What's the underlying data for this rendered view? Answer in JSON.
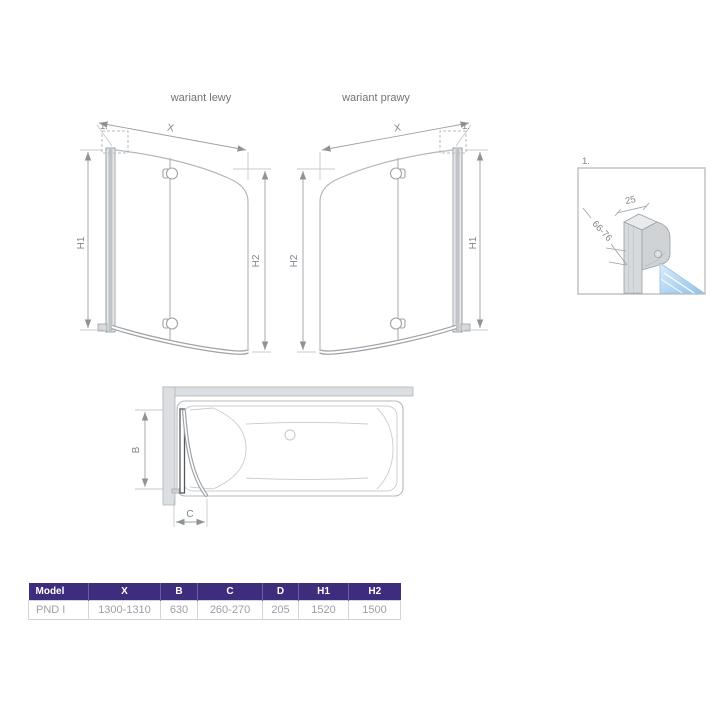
{
  "drawing": {
    "variant_left_title": "wariant lewy",
    "variant_right_title": "wariant prawy",
    "detail_ref": "1.",
    "dim_x": "X",
    "dim_h1": "H1",
    "dim_h2": "H2",
    "dim_b": "B",
    "dim_c": "C",
    "detail_width": "25",
    "detail_depth_range": "66-76"
  },
  "table": {
    "headers": [
      "Model",
      "X",
      "B",
      "C",
      "D",
      "H1",
      "H2"
    ],
    "rows": [
      [
        "PND I",
        "1300-1310",
        "630",
        "260-270",
        "205",
        "1520",
        "1500"
      ]
    ]
  },
  "colors": {
    "header_bg": "#3e2d7c",
    "glass_light": "#ddeefb",
    "glass_dark": "#8fc2ea",
    "line_light": "#b7bbbf",
    "line_dark": "#8e9398"
  }
}
